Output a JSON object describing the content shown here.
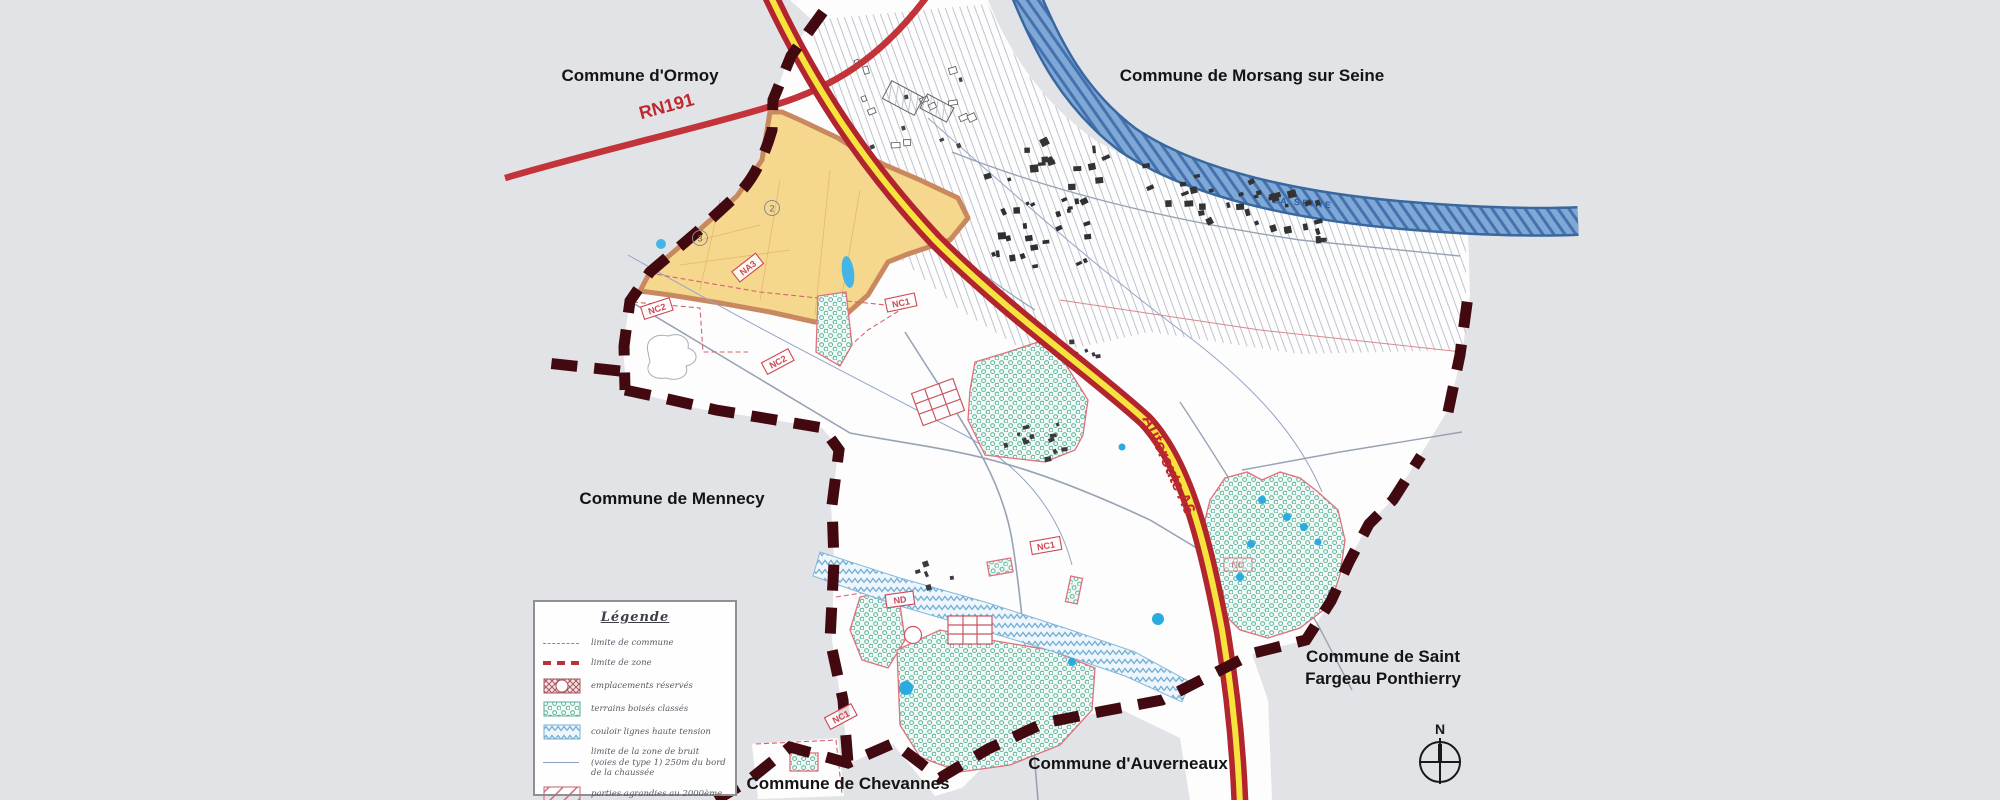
{
  "map": {
    "commune_labels": {
      "ormoy": "Commune d'Ormoy",
      "morsang": "Commune de Morsang sur Seine",
      "mennecy": "Commune de Mennecy",
      "saint_fargeau_line1": "Commune de Saint",
      "saint_fargeau_line2": "Fargeau Ponthierry",
      "auverneaux": "Commune d'Auverneaux",
      "chevannes": "Commune de Chevannes"
    },
    "road_labels": {
      "rn191": "RN191",
      "a6": "Autoroute A6"
    },
    "river_label": "LA SEINE",
    "north_label": "N",
    "zone_labels": [
      "NC2",
      "NC2",
      "NC1",
      "NA3",
      "NC1",
      "NC1",
      "ND",
      "ND"
    ],
    "circled_numbers": [
      "2",
      "3"
    ]
  },
  "legend": {
    "title": "Légende",
    "items": [
      {
        "key": "limite-commune",
        "label": "limite de commune"
      },
      {
        "key": "limite-zone",
        "label": "limite de zone"
      },
      {
        "key": "emplacements-reserves",
        "label": "emplacements réservés"
      },
      {
        "key": "terrains-boises",
        "label": "terrains boisés classés"
      },
      {
        "key": "couloir-ht",
        "label": "couloir lignes haute tension"
      },
      {
        "key": "limite-bruit",
        "label": "limite de la zone de bruit (voies de type 1) 250m du bord de la chaussée"
      },
      {
        "key": "parties-agrandies",
        "label": "parties agrandies au 2000ème"
      }
    ]
  },
  "colors": {
    "background_gray": "#e2e3e6",
    "map_white": "#fdfdfd",
    "hatch_gray": "#b9bdc7",
    "river_fill": "#7ea8d5",
    "river_edge": "#3f6ca8",
    "a6_red": "#b2252e",
    "a6_yellow": "#f6e33e",
    "rn191_red": "#c23439",
    "boundary_maroon": "#420a10",
    "zone_yellow": "#f6d78e",
    "zone_yellow_border": "#c9895f",
    "woods_teal": "#57b09a",
    "corridor_blue": "#79b0d6",
    "zone_label_red": "#cf4553",
    "water_cyan": "#45b5e8"
  }
}
